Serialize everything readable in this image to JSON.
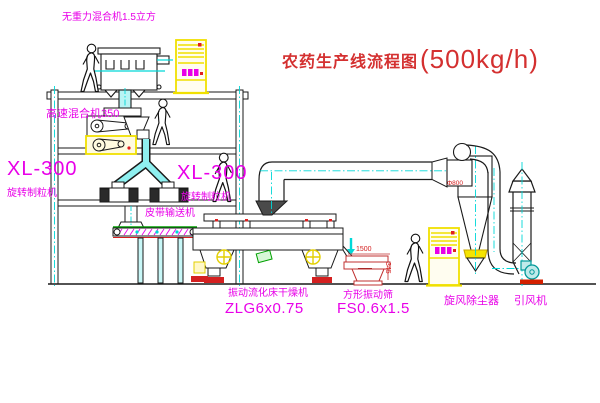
{
  "title": {
    "name_cn": "农药生产线流程图",
    "capacity": "(500kg/h)"
  },
  "equipment_labels": {
    "gravity_mixer": "无重力混合机1.5立方",
    "high_speed_mixer": "高速混合机350",
    "granulator_left_model": "XL-300",
    "granulator_left_name": "旋转制粒机",
    "granulator_right_model": "XL-300",
    "granulator_right_name": "旋转制粒机",
    "belt_conveyor": "皮带输送机",
    "fluid_bed_dryer_name": "振动流化床干燥机",
    "fluid_bed_dryer_model": "ZLG6x0.75",
    "vibrating_screen_name": "方形振动筛",
    "vibrating_screen_model": "FS0.6x1.5",
    "cyclone_dust_collector": "旋风除尘器",
    "induced_draft_fan": "引风机"
  },
  "dimension_labels": {
    "screen_length": "1500",
    "screen_side": "345",
    "cyclone_inlet": "Φ800"
  },
  "colors": {
    "label_magenta": "#e800e8",
    "title_red": "#d43030",
    "centerline_cyan": "#00d8d8",
    "cabinet_yellow": "#f0e000",
    "drawing_black": "#1a1a1a"
  }
}
